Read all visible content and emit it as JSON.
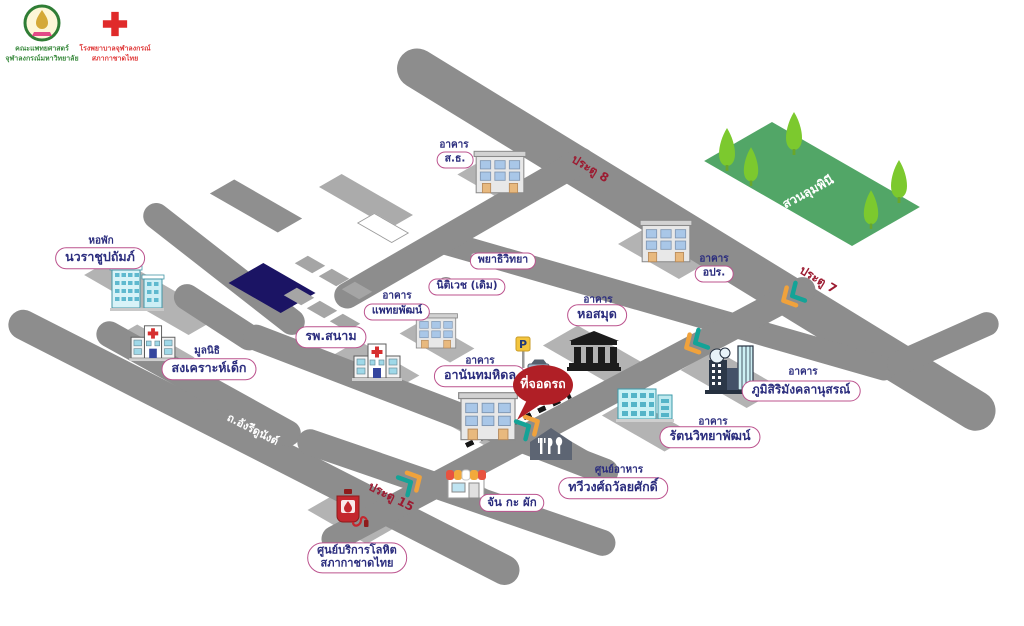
{
  "logos": {
    "faculty": {
      "line1": "คณะแพทยศาสตร์",
      "line2": "จุฬาลงกรณ์มหาวิทยาลัย"
    },
    "red_cross": {
      "line1": "โรงพยาบาลจุฬาลงกรณ์",
      "line2": "สภากาชาดไทย"
    }
  },
  "roads": {
    "ratchadamri": "ถ.ราชดำริ",
    "henri_dunant": "ถ.อังรีดูนังต์"
  },
  "gates": {
    "gate8": "ประตู 8",
    "gate7": "ประตู 7",
    "gate15": "ประตู 15"
  },
  "park": {
    "name": "สวนลุมพินี"
  },
  "parking": {
    "label": "ที่จอดรถ",
    "sign_letter": "P"
  },
  "places": {
    "navarat_dorm": {
      "pre": "หอพัก",
      "name": "นวราชูปถัมภ์"
    },
    "child_foundation": {
      "pre": "มูลนิธิ",
      "name": "สงเคราะห์เด็ก"
    },
    "field_hospital": {
      "name": "รพ.สนาม"
    },
    "phaethayaphat": {
      "pre": "อาคาร",
      "name": "แพทยพัฒน์"
    },
    "sor_thor": {
      "pre": "อาคาร",
      "name": "ส.ธ."
    },
    "opr": {
      "pre": "อาคาร",
      "name": "อปร."
    },
    "pathology": {
      "name": "พยาธิวิทยา"
    },
    "forensic_old": {
      "name": "นิติเวช (เดิม)"
    },
    "library": {
      "pre": "อาคาร",
      "name": "หอสมุด"
    },
    "ananda_mahidol": {
      "pre": "อาคาร",
      "name": "อานันทมหิดล"
    },
    "bhumisiri": {
      "pre": "อาคาร",
      "name": "ภูมิสิริมังคลานุสรณ์"
    },
    "rattana": {
      "pre": "อาคาร",
      "name": "รัตนวิทยาพัฒน์"
    },
    "food_center": {
      "pre": "ศูนย์อาหาร",
      "name": "ทวีวงศ์ถวัลยศักดิ์"
    },
    "jan_ka_phak": {
      "name": "จัน กะ ผัก"
    },
    "blood_center": {
      "line1": "ศูนย์บริการโลหิต",
      "line2": "สภากาชาดไทย"
    }
  },
  "colors": {
    "road": "#8d8d8d",
    "park_green": "#52a667",
    "tree_green": "#7cc92e",
    "pill_border": "#bc538e",
    "label_navy": "#2b2d7e",
    "gate_red": "#9c1b31",
    "balloon_red": "#b01f26",
    "navy_block": "#1b1464",
    "chevron_orange": "#f0a23c",
    "chevron_teal": "#14a397"
  }
}
